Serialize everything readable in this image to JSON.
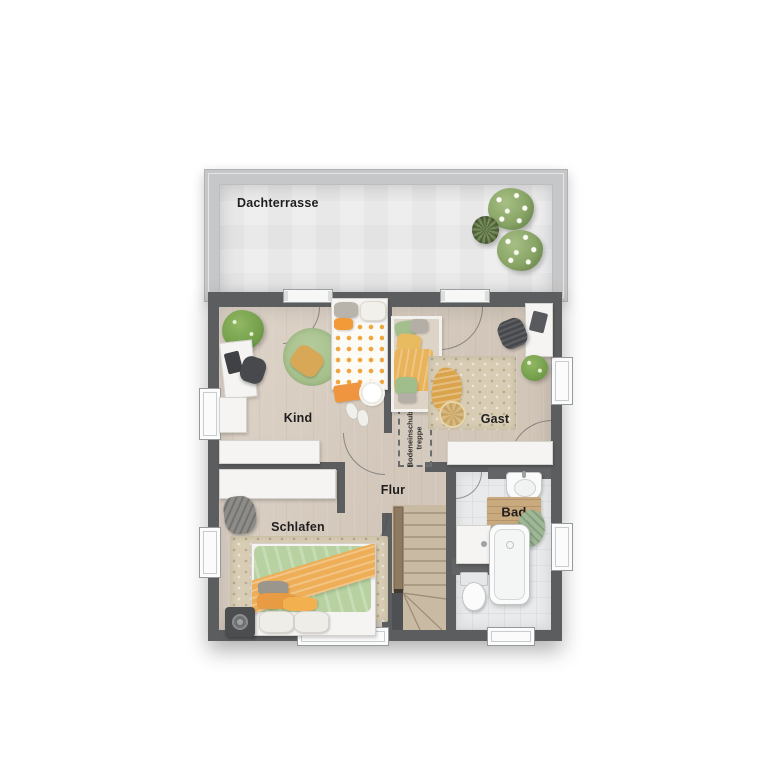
{
  "plan": {
    "terrace_label": "Dachterrasse",
    "rooms": {
      "kind": "Kind",
      "gast": "Gast",
      "flur": "Flur",
      "schlafen": "Schlafen",
      "bad": "Bad"
    },
    "attic_hatch": {
      "line1": "Bodeneinschub-",
      "line2": "treppe"
    }
  },
  "colors": {
    "wall": "#5b5d5f",
    "wood_floor": "#d9cdc0",
    "terrace_parapet": "#c6c7c8",
    "terrace_floor": "#ededee",
    "bath_tile": "#e8eaeb",
    "rug_green": "#a4bf8a",
    "rug_beige": "#d8cdb4",
    "accent_orange": "#efa94a",
    "accent_green": "#b7d2a0",
    "stair_wood": "#c9baa4",
    "label_text": "#1e1e1e"
  }
}
